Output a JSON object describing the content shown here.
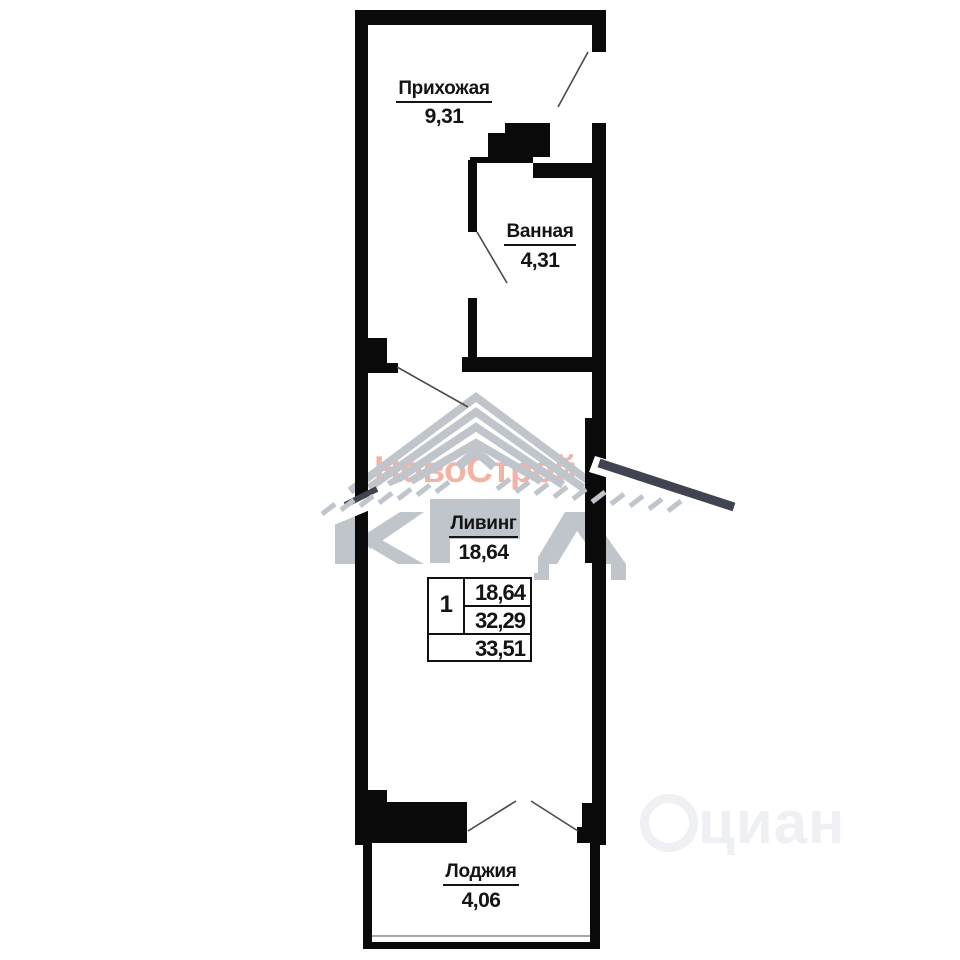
{
  "plan": {
    "type": "apartment-floor-plan",
    "rooms": {
      "hallway": {
        "name": "Прихожая",
        "area": "9,31"
      },
      "bathroom": {
        "name": "Ванная",
        "area": "4,31"
      },
      "living": {
        "name": "Ливинг",
        "area": "18,64"
      },
      "loggia": {
        "name": "Лоджия",
        "area": "4,06"
      }
    },
    "info_table": {
      "rooms_count": "1",
      "living_area": "18,64",
      "apartment_area": "32,29",
      "total_area": "33,51"
    }
  },
  "watermarks": {
    "brand": "НовоСтрой",
    "logo_letters": "КПД",
    "site": "циан"
  },
  "colors": {
    "wall": "#0a0a0a",
    "brand_text": "#f2b3a4",
    "logo_gray": "#c0c5cc",
    "logo_dark": "#3f4450",
    "site_watermark": "#eef0f3"
  }
}
